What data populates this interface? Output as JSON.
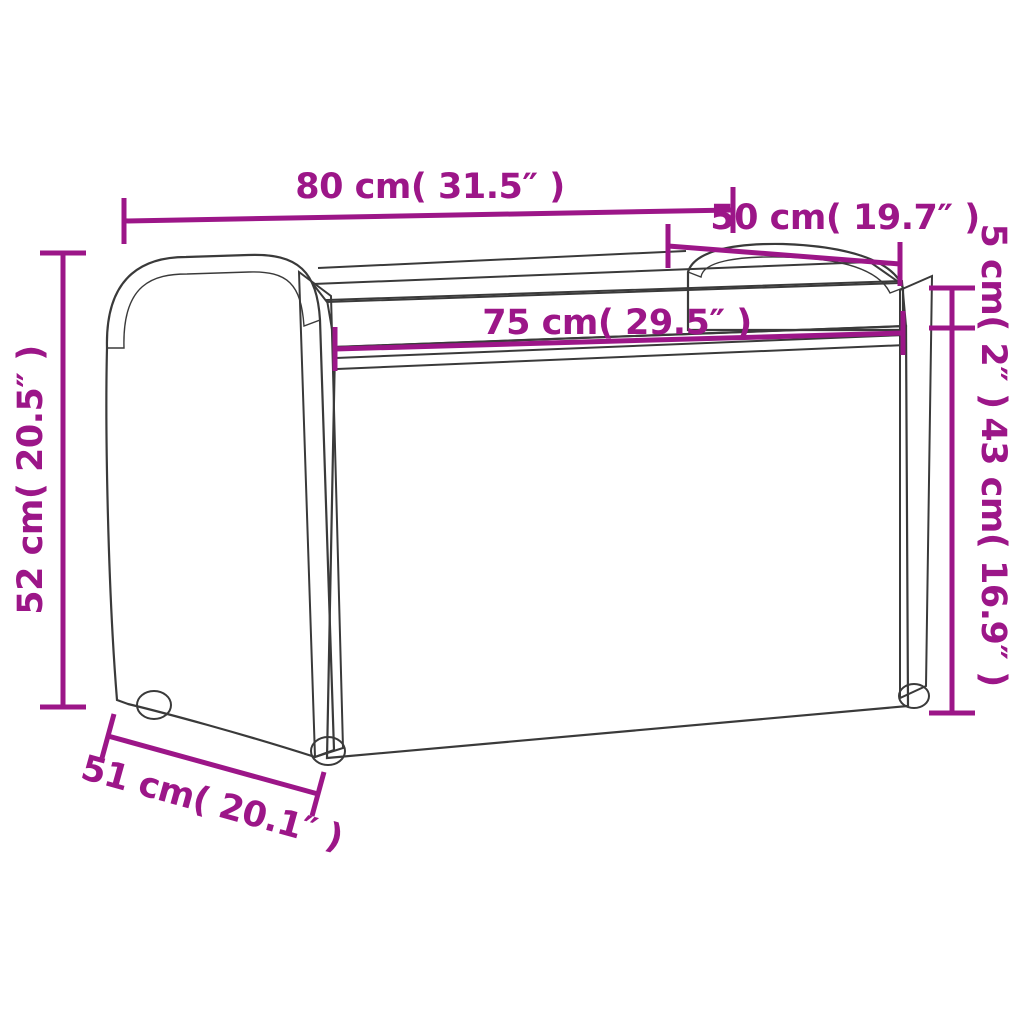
{
  "diagram": {
    "accent_color": "#9C1688",
    "outline_color": "#3A3A3A",
    "background_color": "#FFFFFF",
    "dimensions": {
      "top_width": {
        "label": "80 cm( 31.5″ )",
        "value_cm": 80,
        "value_inch": 31.5
      },
      "armrest_depth": {
        "label": "50 cm( 19.7″ )",
        "value_cm": 50,
        "value_inch": 19.7
      },
      "cushion_thickness": {
        "label": "5 cm( 2″ )",
        "value_cm": 5,
        "value_inch": 2
      },
      "seat_width": {
        "label": "75 cm( 29.5″ )",
        "value_cm": 75,
        "value_inch": 29.5
      },
      "side_height": {
        "label": "43 cm( 16.9″ )",
        "value_cm": 43,
        "value_inch": 16.9
      },
      "overall_height": {
        "label": "52 cm( 20.5″ )",
        "value_cm": 52,
        "value_inch": 20.5
      },
      "depth": {
        "label": "51 cm( 20.1″ )",
        "value_cm": 51,
        "value_inch": 20.1
      }
    }
  }
}
